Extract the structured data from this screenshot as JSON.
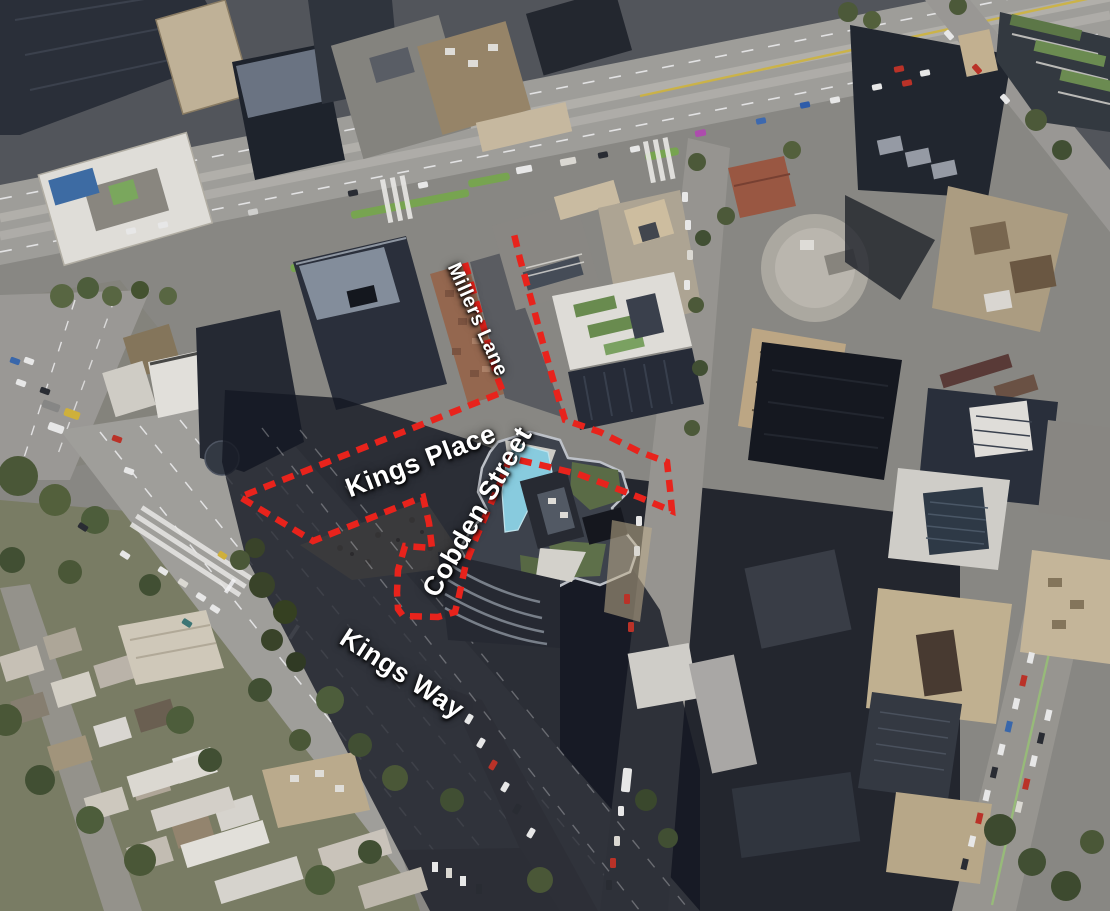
{
  "map": {
    "kind_label": "annotated aerial site plan",
    "colors": {
      "boundary_red": "#e8231c",
      "label_white": "#ffffff",
      "pool_cyan": "#8ed4e6"
    },
    "street_labels": [
      {
        "id": "millers-lane",
        "text": "Millers Lane",
        "x": 462,
        "y": 260,
        "rotation_deg": 66,
        "font_px": 20
      },
      {
        "id": "kings-place",
        "text": "Kings Place",
        "x": 342,
        "y": 477,
        "rotation_deg": -21,
        "font_px": 27
      },
      {
        "id": "cobden-street",
        "text": "Cobden Street",
        "x": 418,
        "y": 588,
        "rotation_deg": -60,
        "font_px": 27
      },
      {
        "id": "kings-way",
        "text": "Kings Way",
        "x": 350,
        "y": 624,
        "rotation_deg": 33,
        "font_px": 27
      }
    ],
    "site_boundary": {
      "stroke_width": 6.5,
      "dash_pattern": "12 8",
      "points": [
        [
          465,
          263
        ],
        [
          472,
          287
        ],
        [
          485,
          332
        ],
        [
          497,
          377
        ],
        [
          503,
          392
        ],
        [
          240,
          497
        ],
        [
          313,
          541
        ],
        [
          423,
          497
        ],
        [
          429,
          523
        ],
        [
          432,
          548
        ],
        [
          405,
          546
        ],
        [
          398,
          570
        ],
        [
          397,
          593
        ],
        [
          398,
          609
        ],
        [
          403,
          616
        ],
        [
          438,
          617
        ],
        [
          455,
          612
        ],
        [
          459,
          596
        ],
        [
          466,
          563
        ],
        [
          476,
          538
        ],
        [
          488,
          510
        ],
        [
          500,
          483
        ],
        [
          510,
          458
        ],
        [
          545,
          466
        ],
        [
          578,
          474
        ],
        [
          610,
          486
        ],
        [
          641,
          498
        ],
        [
          672,
          511
        ],
        [
          670,
          489
        ],
        [
          667,
          462
        ],
        [
          640,
          452
        ],
        [
          600,
          432
        ],
        [
          565,
          420
        ],
        [
          557,
          393
        ],
        [
          545,
          351
        ],
        [
          533,
          306
        ],
        [
          520,
          259
        ],
        [
          513,
          230
        ]
      ]
    }
  }
}
